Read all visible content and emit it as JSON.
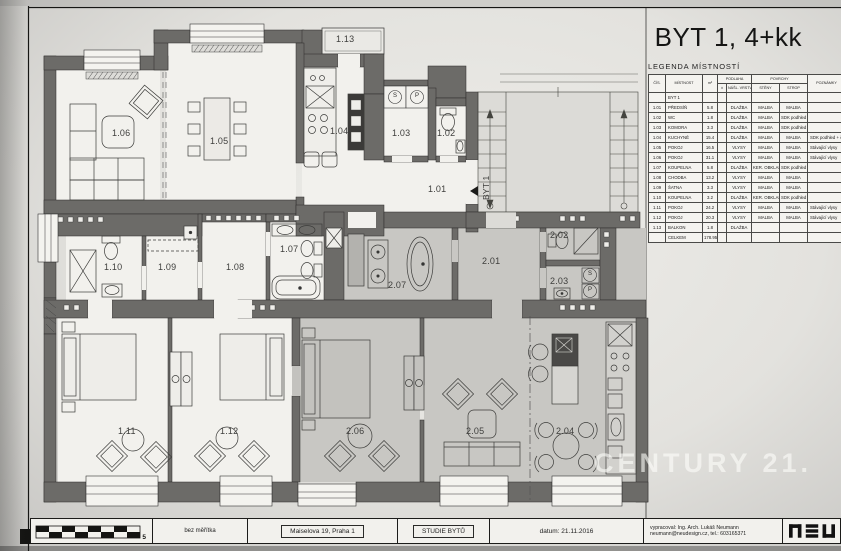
{
  "title": "BYT 1, 4+kk",
  "legend": {
    "heading": "LEGENDA MÍSTNOSTÍ",
    "header": {
      "cis": "ČÍS.",
      "mistnost": "MÍSTNOST",
      "m2": "m²",
      "podlaha": "PODLAHA",
      "vyska": "±",
      "nasl": "NÁŠL. VRSTVA",
      "povrchy": "POVRCHY",
      "steny": "STĚNY",
      "strop": "STROP",
      "poznamky": "POZNÁMKY"
    },
    "rows": [
      [
        "",
        "BYT 1",
        "",
        "",
        "",
        "",
        "",
        ""
      ],
      [
        "1.01",
        "PŘEDSÍŇ",
        "5.8",
        "",
        "DLAŽBA",
        "MALBA",
        "MALBA",
        ""
      ],
      [
        "1.02",
        "WC",
        "1.8",
        "",
        "DLAŽBA",
        "MALBA",
        "SDK podhled",
        ""
      ],
      [
        "1.03",
        "KOMORA",
        "3.3",
        "",
        "DLAŽBA",
        "MALBA",
        "SDK podhled",
        ""
      ],
      [
        "1.04",
        "KUCHYNĚ",
        "15.4",
        "",
        "DLAŽBA",
        "MALBA",
        "MALBA",
        "SDK podhled + část"
      ],
      [
        "1.05",
        "POKOJ",
        "16.5",
        "",
        "VLYSY",
        "MALBA",
        "MALBA",
        "Stávající vlysy"
      ],
      [
        "1.06",
        "POKOJ",
        "31.1",
        "",
        "VLYSY",
        "MALBA",
        "MALBA",
        "Stávající vlysy"
      ],
      [
        "1.07",
        "KOUPELNA",
        "5.8",
        "",
        "DLAŽBA",
        "KER. OBKLAD",
        "SDK podhled",
        ""
      ],
      [
        "1.08",
        "CHODBA",
        "13.2",
        "",
        "VLYSY",
        "MALBA",
        "MALBA",
        ""
      ],
      [
        "1.09",
        "ŠATNA",
        "3.3",
        "",
        "VLYSY",
        "MALBA",
        "MALBA",
        ""
      ],
      [
        "1.10",
        "KOUPELNA",
        "3.2",
        "",
        "DLAŽBA",
        "KER. OBKLAD",
        "SDK podhled",
        ""
      ],
      [
        "1.11",
        "POKOJ",
        "24.2",
        "",
        "VLYSY",
        "MALBA",
        "MALBA",
        "Stávající vlysy"
      ],
      [
        "1.12",
        "POKOJ",
        "20.3",
        "",
        "VLYSY",
        "MALBA",
        "MALBA",
        "Stávající vlysy"
      ],
      [
        "1.13",
        "BALKON",
        "1.8",
        "",
        "DLAŽBA",
        "",
        "",
        ""
      ],
      [
        "",
        "CELKEM",
        "178.95",
        "",
        "",
        "",
        "",
        ""
      ]
    ]
  },
  "plan": {
    "byt_marker": "BYT 1",
    "s_letter": "S",
    "p_letter": "P",
    "rooms": {
      "r101": "1.01",
      "r102": "1.02",
      "r103": "1.03",
      "r104": "1.04",
      "r105": "1.05",
      "r106": "1.06",
      "r107": "1.07",
      "r108": "1.08",
      "r109": "1.09",
      "r110": "1.10",
      "r111": "1.11",
      "r112": "1.12",
      "r113": "1.13",
      "r201": "2.01",
      "r202": "2.02",
      "r203": "2.03",
      "r204": "2.04",
      "r205": "2.05",
      "r206": "2.06",
      "r207": "2.07"
    }
  },
  "watermark": "CENTURY 21.",
  "titleblock": {
    "scale_number": "5",
    "scale_note": "bez měřítka",
    "address": "Maiselova 19, Praha 1",
    "doc_type": "STUDIE BYTŮ",
    "date": "datum: 21.11.2016",
    "author_line1": "vypracoval: Ing. Arch. Lukáš Neumann",
    "author_line2": "neumann@neudesign.cz, tel.: 603165371",
    "logo": "neu"
  }
}
